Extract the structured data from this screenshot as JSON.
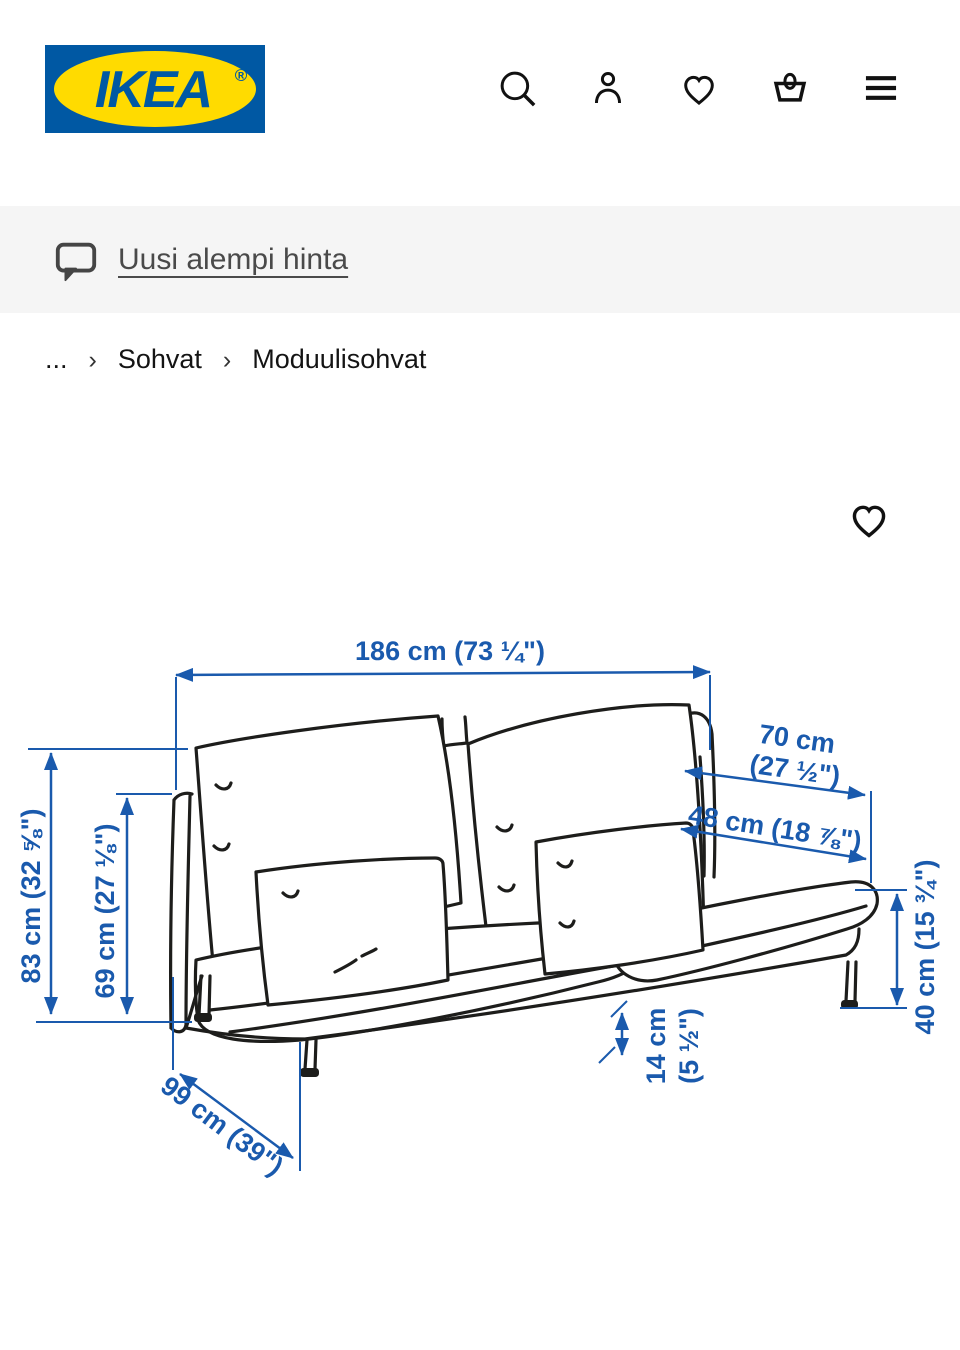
{
  "header": {
    "logo_text": "IKEA",
    "logo_registered": "®",
    "icons": [
      "search",
      "profile",
      "wishlist",
      "shopping-bag",
      "menu"
    ]
  },
  "banner": {
    "link_label": "Uusi alempi hinta"
  },
  "breadcrumb": {
    "separator": "›",
    "items": [
      "...",
      "Sohvat",
      "Moduulisohvat"
    ]
  },
  "diagram": {
    "type": "product-dimension-illustration",
    "dimensions": {
      "total_width": "186 cm (73 ¼\")",
      "total_height": "83 cm (32 ⅝\")",
      "armrest_height": "69 cm (27 ⅛\")",
      "back_width_cm": "70 cm",
      "back_width_in": "(27 ½\")",
      "cushion_width": "48 cm (18 ⅞\")",
      "seat_height": "40 cm (15 ¾\")",
      "clearance_cm": "14 cm",
      "clearance_in": "(5 ½\")",
      "depth": "99 cm (39\")"
    }
  },
  "colors": {
    "ikea_blue": "#0058A3",
    "ikea_yellow": "#FFDB00",
    "dimension_blue": "#1A5AAD",
    "icon_dark": "#111111",
    "banner_bg": "#F5F5F5",
    "banner_text": "#4A4A4A"
  }
}
